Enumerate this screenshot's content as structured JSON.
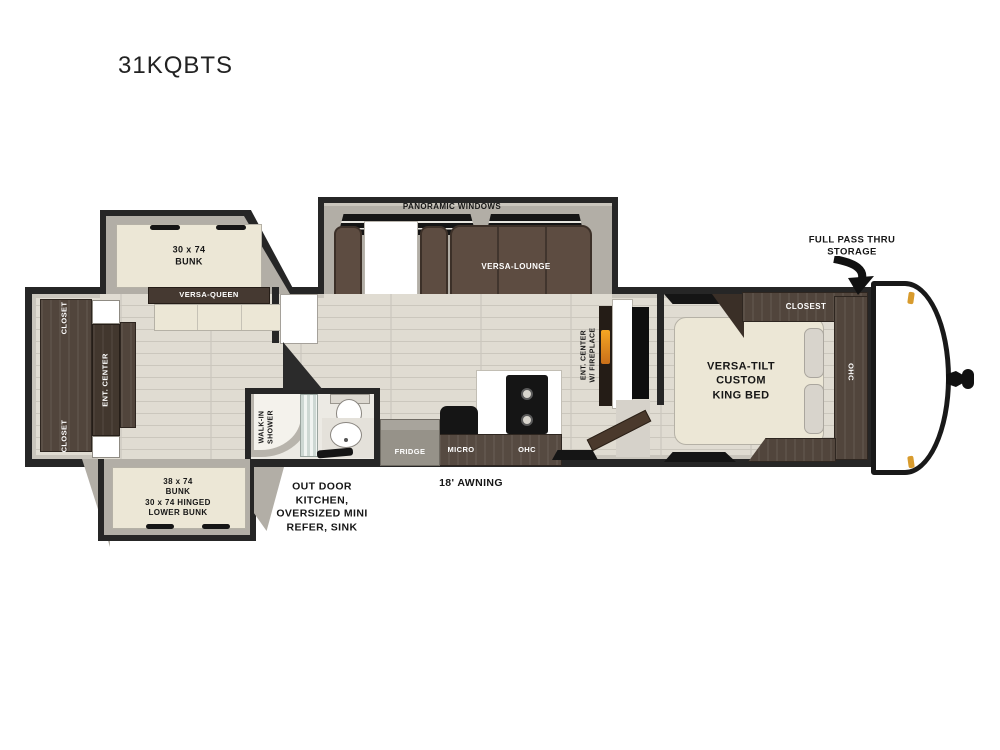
{
  "title": "31KQBTS",
  "labels": {
    "panoramic_windows": "PANORAMIC WINDOWS",
    "versa_lounge": "VERSA-LOUNGE",
    "bunk_top": "30 x 74\nBUNK",
    "versa_queen": "VERSA-QUEEN",
    "closet_top": "CLOSET",
    "ent_center": "ENT. CENTER",
    "closet_bottom": "CLOSET",
    "bunk_bottom": "38 x 74\nBUNK\n30 x 74 HINGED\nLOWER BUNK",
    "outdoor_kitchen": "OUT DOOR\nKITCHEN,\nOVERSIZED MINI\nREFER, SINK",
    "walk_in_shower": "WALK-IN\nSHOWER",
    "fridge": "FRIDGE",
    "micro": "MICRO",
    "ohc_kitchen": "OHC",
    "awning": "18' AWNING",
    "ent_center_fireplace": "ENT. CENTER\nW/ FIREPLACE",
    "king_bed": "VERSA-TILT\nCUSTOM\nKING BED",
    "closet_bedroom": "CLOSEST",
    "ohc_bedroom": "OHC",
    "full_pass_thru": "FULL PASS THRU\nSTORAGE"
  },
  "colors": {
    "wall": "#262626",
    "lining": "#c9c5bc",
    "floor": "#e0dcd2",
    "plank": "#cbc7bd",
    "slide_floor": "#b2aea6",
    "wood": "#51453c",
    "wood_dark": "#42372e",
    "sofa": "#5d4c41",
    "cream": "#ece7d6",
    "pillow": "#d8d4cc",
    "fridge": "#969289",
    "black": "#151515",
    "fireplace": "#e89b2e",
    "marker": "#d89b2d",
    "ink": "#161616"
  }
}
